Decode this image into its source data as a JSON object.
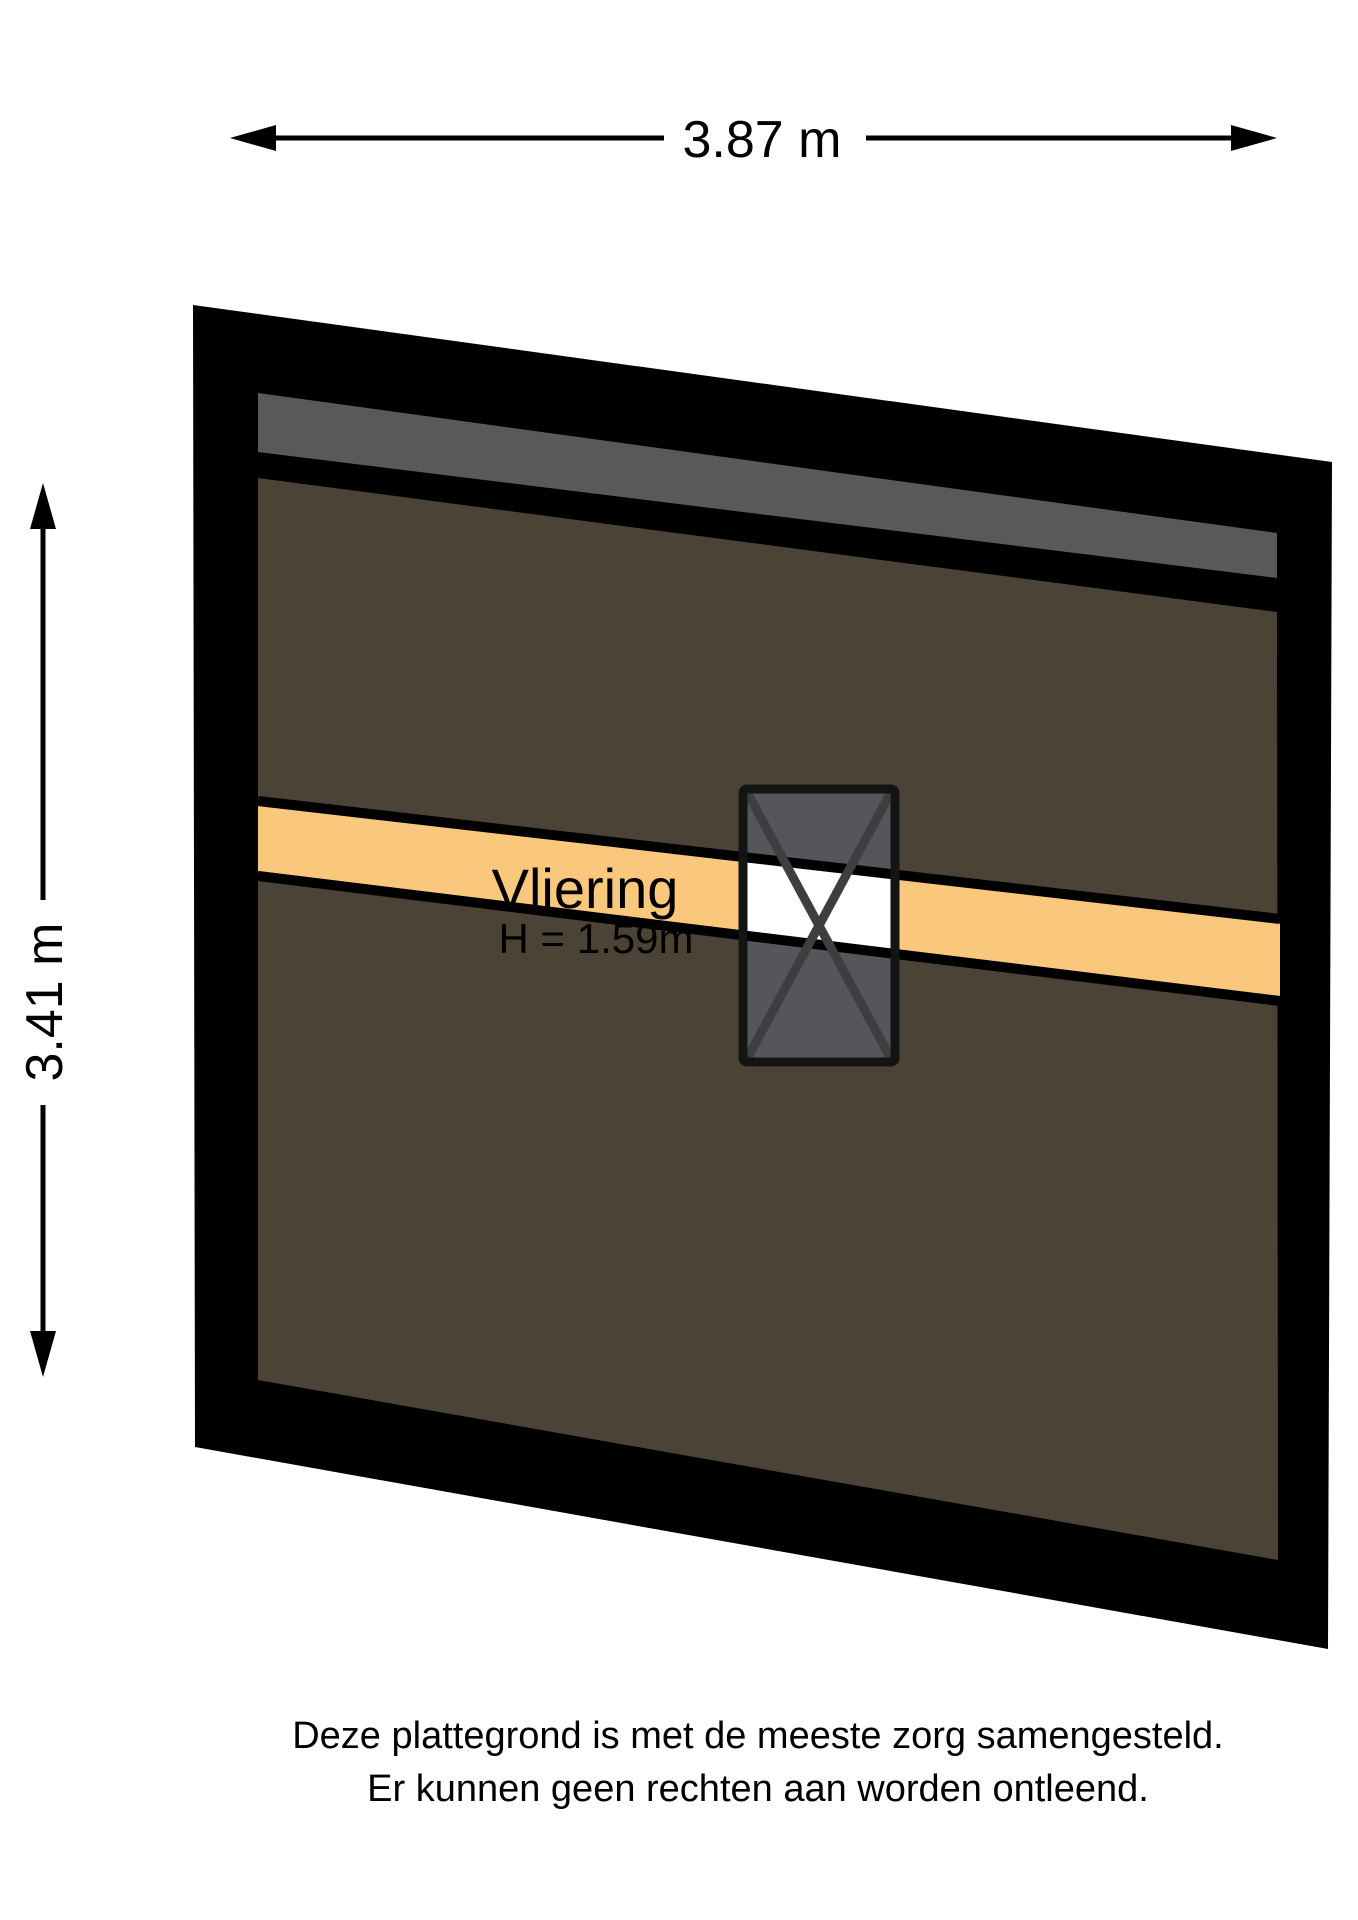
{
  "dimension_top": {
    "label": "3.87 m"
  },
  "dimension_left": {
    "label": "3.41 m"
  },
  "room": {
    "name": "Vliering",
    "height_label": "H = 1.59m"
  },
  "disclaimer": {
    "line1": "Deze plattegrond is met de meeste zorg samengesteld.",
    "line2": "Er kunnen geen rechten aan worden ontleend."
  },
  "colors": {
    "wall_black": "#000000",
    "roof_gray": "#58595b",
    "floor_brown": "#4b4335",
    "loft_orange": "#fac87c",
    "hatch_gray": "#545659",
    "hatch_cross": "#3d3e40",
    "hatch_border": "#141414",
    "opening_white": "#ffffff",
    "line_black": "#000000"
  }
}
